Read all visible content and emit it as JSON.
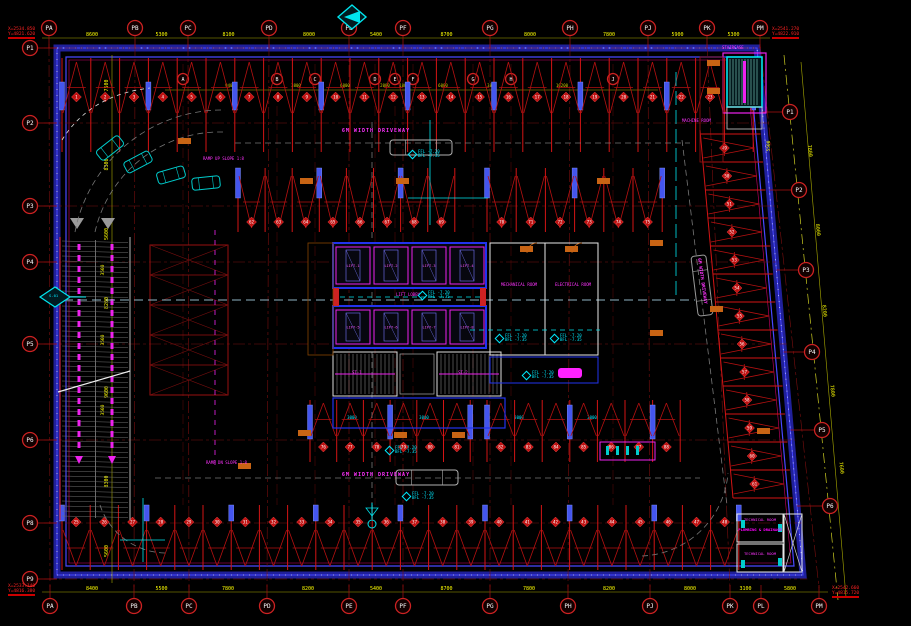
{
  "drawing": {
    "colors": {
      "background": "#000000",
      "hatch_red": "#b51111",
      "wall_blue": "#2a2ae0",
      "dim_yellow": "#ffff00",
      "label_magenta": "#ff33ff",
      "level_cyan": "#00eaff",
      "note_red": "#ff2222",
      "door_orange": "#c86414"
    },
    "driveway_label": "6M WIDTH DRIVEWAY",
    "ramp_up_label": "RAMP UP SLOPE 1:8",
    "ramp_dn_label": "RAMP DN SLOPE 1:8",
    "levels": {
      "ffl": "FFL -7.20",
      "bfl": "BFL -7.35"
    },
    "markers": {
      "section": "S-01",
      "north": "N"
    },
    "notes": {
      "top_left": [
        "X=2534.850",
        "Y=4821.620"
      ],
      "top_right": [
        "X=2541.270",
        "Y=4822.910"
      ],
      "bottom_left": [
        "X=2533.140",
        "Y=4816.380"
      ],
      "bottom_right": [
        "X=2542.660",
        "Y=4815.720"
      ]
    },
    "grid": {
      "top": [
        "PA",
        "PB",
        "PC",
        "PD",
        "PE",
        "PF",
        "PG",
        "PH",
        "PJ",
        "PK",
        "PM"
      ],
      "bottom": [
        "PA",
        "PB",
        "PC",
        "PD",
        "PE",
        "PF",
        "PG",
        "PH",
        "PJ",
        "PK",
        "PL",
        "PM"
      ],
      "left": [
        "P1",
        "P2",
        "P3",
        "P4",
        "P5",
        "P6",
        "P8",
        "P9"
      ],
      "right": [
        "P1",
        "P2",
        "P3",
        "P4",
        "P5",
        "P6"
      ],
      "letters": [
        "A",
        "B",
        "C",
        "D",
        "E",
        "F",
        "G",
        "H",
        "J"
      ]
    },
    "dims": {
      "top": [
        "8600",
        "5300",
        "8100",
        "8000",
        "5400",
        "8700",
        "8000",
        "7800",
        "5900",
        "5300"
      ],
      "bottom": [
        "8400",
        "5500",
        "7800",
        "8200",
        "5400",
        "8700",
        "7800",
        "8200",
        "8000",
        "3100",
        "5800"
      ],
      "left": [
        "7500",
        "8300",
        "5600",
        "8200",
        "9600",
        "8300",
        "5600"
      ],
      "right": [
        "7800",
        "8000",
        "8200",
        "7800",
        "7600"
      ],
      "letters": [
        "9400",
        "3800",
        "6000",
        "2000",
        "1800",
        "6000",
        "3800",
        "10200"
      ],
      "ramp": [
        "3500",
        "3500",
        "3500"
      ],
      "inner_right": "5500",
      "stall_width": "3000"
    },
    "rooms": {
      "lifts_top": [
        "LIFT-1",
        "LIFT-2",
        "LIFT-3",
        "LIFT-4"
      ],
      "lifts_bottom": [
        "LIFT-5",
        "LIFT-6",
        "LIFT-7",
        "LIFT-8"
      ],
      "stairs": [
        "ST-1",
        "ST-2"
      ],
      "lobby": "LIFT LOBBY",
      "mech": "MECHANICAL ROOM",
      "elec": "ELECTRICAL ROOM",
      "machine": "MACHINE ROOM",
      "staircase": "STAIRCASE",
      "technical": [
        "TECHNICAL ROOM",
        "TECHNICAL ROOM"
      ],
      "pump": "PLUMBING & DRAINAGE"
    },
    "stalls": {
      "top": [
        "1",
        "2",
        "3",
        "4",
        "5",
        "6",
        "7",
        "8",
        "9",
        "10",
        "11",
        "12",
        "13",
        "14",
        "15",
        "16",
        "17",
        "18",
        "19",
        "20",
        "21",
        "22",
        "23",
        "24"
      ],
      "bottom": [
        "25",
        "26",
        "27",
        "28",
        "29",
        "30",
        "31",
        "32",
        "33",
        "34",
        "35",
        "36",
        "37",
        "38",
        "39",
        "40",
        "41",
        "42",
        "43",
        "44",
        "45",
        "46",
        "47",
        "48"
      ],
      "right": [
        "49",
        "50",
        "51",
        "52",
        "53",
        "54",
        "55",
        "56",
        "57",
        "58",
        "59",
        "60",
        "61"
      ],
      "inner_top": [
        "62",
        "63",
        "64",
        "65",
        "66",
        "67",
        "68",
        "69",
        "70",
        "71",
        "72",
        "73",
        "74",
        "75"
      ],
      "inner_bottom": [
        "76",
        "77",
        "78",
        "79",
        "80",
        "81",
        "82",
        "83",
        "84",
        "85",
        "86",
        "87",
        "88"
      ]
    }
  }
}
